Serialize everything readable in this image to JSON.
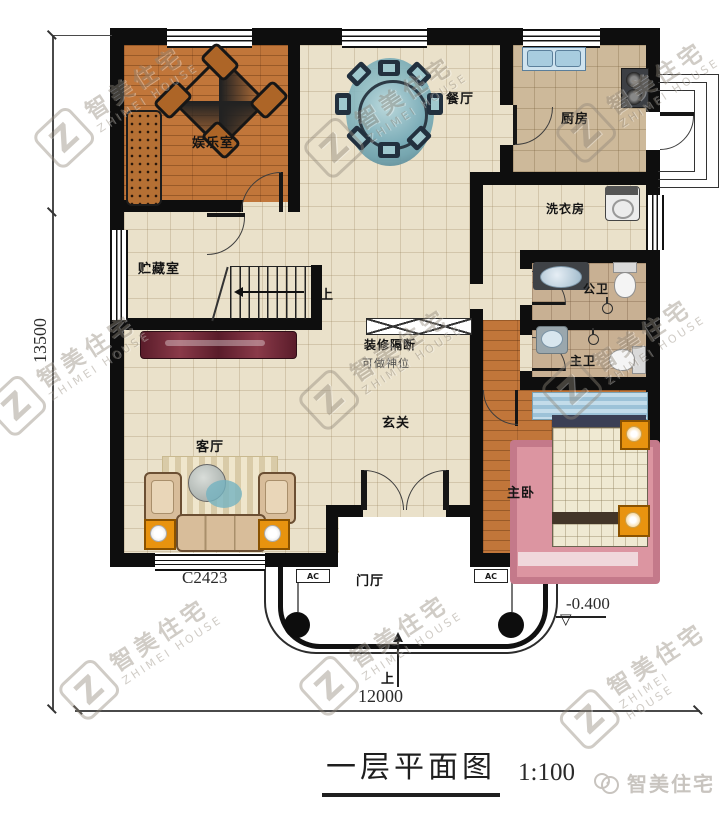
{
  "title": {
    "name": "一层平面图",
    "scale": "1:100"
  },
  "brand": {
    "name": "智美住宅"
  },
  "watermark": {
    "z": "Z",
    "cn": "智美住宅",
    "en": "ZHIMEI HOUSE"
  },
  "rooms": {
    "entertainment": {
      "label": "娱乐室"
    },
    "dining": {
      "label": "餐厅"
    },
    "kitchen": {
      "label": "厨房"
    },
    "laundry": {
      "label": "洗衣房"
    },
    "public_bath": {
      "label": "公卫"
    },
    "master_bath": {
      "label": "主卫"
    },
    "storage": {
      "label": "贮藏室"
    },
    "living": {
      "label": "客厅"
    },
    "foyer": {
      "label": "玄关"
    },
    "master_bedroom": {
      "label": "主卧"
    },
    "porch": {
      "label": "门厅"
    }
  },
  "annotations": {
    "partition": "装修隔断",
    "partition_note": "可做神位",
    "stairs_up": "上",
    "porch_up": "上"
  },
  "dimensions": {
    "total_width": "12000",
    "total_height": "13500",
    "elevation": "-0.400",
    "window_label": "C2423",
    "ac_label": "AC"
  },
  "colors": {
    "wall": "#0e0e0e",
    "wood_floor": "#c1763a",
    "tile_floor": "#eae1ca",
    "accent_orange": "#e8930f"
  }
}
